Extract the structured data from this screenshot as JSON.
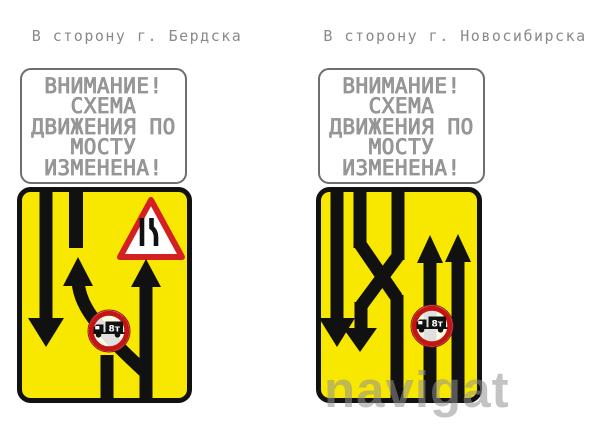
{
  "titles": {
    "left": "В сторону г. Бердска",
    "right": "В сторону г. Новосибирска"
  },
  "warning_lines": [
    "ВНИМАНИЕ!",
    "СХЕМА",
    "ДВИЖЕНИЯ ПО",
    "МОСТУ",
    "ИЗМЕНЕНА!"
  ],
  "truck_badge": "8т",
  "watermark": "navigat",
  "colors": {
    "sign_yellow": "#F8E800",
    "sign_border": "#111111",
    "prohibition_red": "#C41414",
    "triangle_red": "#D42020",
    "warning_text_gray": "#9a9a9a",
    "title_gray": "#8a8a8a",
    "watermark_gray": "rgba(145,145,145,0.55)"
  }
}
